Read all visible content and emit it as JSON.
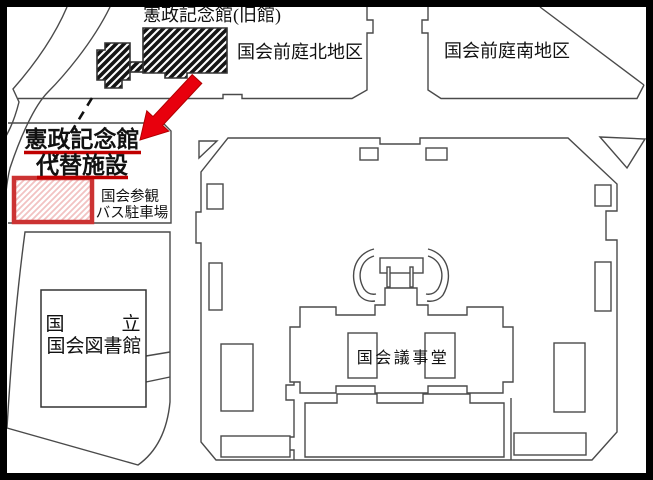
{
  "map": {
    "labels": {
      "old_hall": "憲政記念館(旧館)",
      "north_garden": "国会前庭北地区",
      "south_garden": "国会前庭南地区",
      "facility_line1": "憲政記念館",
      "facility_line2": "代替施設",
      "bus_parking_line1": "国会参観",
      "bus_parking_line2": "バス駐車場",
      "library_line1": "国　　　立",
      "library_line2": "国会図書館",
      "diet_building": "国会議事堂"
    },
    "colors": {
      "arrow_red": "#e8000d",
      "underline_red": "#c00000",
      "parking_border_red": "#cc3333",
      "parking_hatch_pink": "#f2c2c2",
      "hatch_black": "#151515",
      "outline_gray": "#4a4a4a",
      "border_black": "#000000"
    }
  }
}
